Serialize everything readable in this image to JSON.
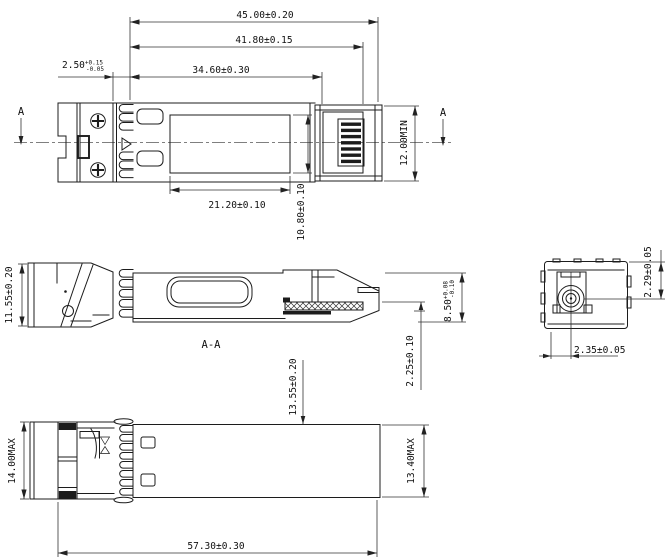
{
  "top_view": {
    "section_a_left": "A",
    "section_a_right": "A",
    "dim_overall": "45.00±0.20",
    "dim_to_latch": "41.80±0.15",
    "dim_to_body": "34.60±0.30",
    "dim_front": {
      "nominal": "2.50",
      "plus": "+0.15",
      "minus": "-0.05"
    },
    "dim_label_width": "21.20±0.10",
    "dim_label_height": "10.80±0.10",
    "dim_connector_width": "12.00MIN"
  },
  "section_view": {
    "title": "A-A",
    "dim_front_height": "11.55±0.20",
    "dim_body_height": {
      "nominal": "8.50",
      "plus": "+0.08",
      "minus": "-0.10"
    },
    "dim_pcb_offset": "2.25±0.10",
    "dim_axis_height": "13.55±0.20"
  },
  "bottom_view": {
    "dim_front_height": "14.00MAX",
    "dim_body_height": "13.40MAX",
    "dim_overall_length": "57.30±0.30"
  },
  "end_view": {
    "dim_axis_vertical": "2.29±0.05",
    "dim_axis_horizontal": "2.35±0.05"
  }
}
